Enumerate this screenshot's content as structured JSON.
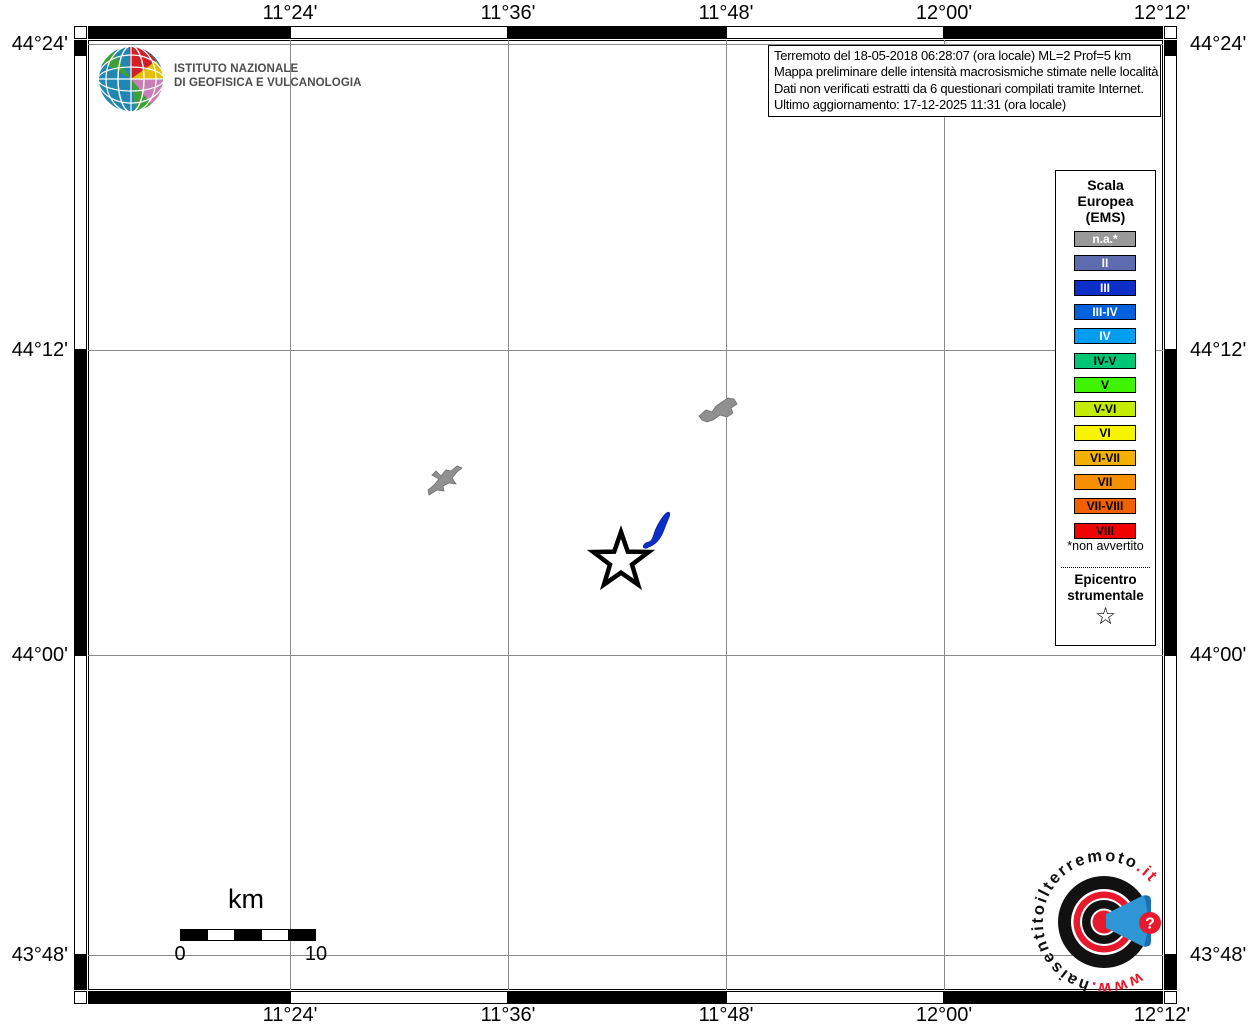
{
  "header": {
    "logo": {
      "line1": "ISTITUTO NAZIONALE",
      "line2": "DI GEOFISICA E VULCANOLOGIA"
    },
    "info_box": {
      "lines": [
        "Terremoto del 18-05-2018 06:28:07 (ora locale) ML=2 Prof=5 km",
        "Mappa preliminare delle intensità macrosismiche stimate nelle località",
        "Dati non verificati estratti da 6 questionari compilati tramite Internet.",
        "Ultimo aggiornamento: 17-12-2025 11:31 (ora locale)"
      ]
    }
  },
  "axes": {
    "top": [
      "11°24'",
      "11°36'",
      "11°48'",
      "12°00'",
      "12°12'"
    ],
    "bottom": [
      "11°24'",
      "11°36'",
      "11°48'",
      "12°00'",
      "12°12'"
    ],
    "left": [
      "44°24'",
      "44°12'",
      "44°00'",
      "43°48'"
    ],
    "right": [
      "44°24'",
      "44°12'",
      "44°00'",
      "43°48'"
    ]
  },
  "legend": {
    "title_lines": [
      "Scala",
      "Europea",
      "(EMS)"
    ],
    "items": [
      {
        "label": "n.a.*",
        "color": "#999999",
        "text_color": "#ffffff"
      },
      {
        "label": "II",
        "color": "#5c6cae",
        "text_color": "#ffffff"
      },
      {
        "label": "III",
        "color": "#0d2ec8",
        "text_color": "#ffffff"
      },
      {
        "label": "III-IV",
        "color": "#0060dd",
        "text_color": "#ffffff"
      },
      {
        "label": "IV",
        "color": "#009df0",
        "text_color": "#ffffff"
      },
      {
        "label": "IV-V",
        "color": "#00c775",
        "text_color": "#000000"
      },
      {
        "label": "V",
        "color": "#3ef400",
        "text_color": "#000000"
      },
      {
        "label": "V-VI",
        "color": "#c3ec00",
        "text_color": "#000000"
      },
      {
        "label": "VI",
        "color": "#f7f400",
        "text_color": "#000000"
      },
      {
        "label": "VI-VII",
        "color": "#f2b000",
        "text_color": "#000000"
      },
      {
        "label": "VII",
        "color": "#f79000",
        "text_color": "#000000"
      },
      {
        "label": "VII-VIII",
        "color": "#f06000",
        "text_color": "#000000"
      },
      {
        "label": "VIII",
        "color": "#f30000",
        "text_color": "#000000"
      }
    ],
    "footnote": "*non avvertito",
    "epicenter_label_lines": [
      "Epicentro",
      "strumentale"
    ],
    "epicenter_symbol": "☆"
  },
  "scalebar": {
    "unit": "km",
    "start": "0",
    "end": "10"
  },
  "map": {
    "epicenter": {
      "symbol": "star",
      "x": 621,
      "y": 561
    },
    "localities": [
      {
        "intensity": "n.a.",
        "color": "#909090",
        "x": 445,
        "y": 480
      },
      {
        "intensity": "n.a.",
        "color": "#909090",
        "x": 718,
        "y": 409
      },
      {
        "intensity": "III",
        "color": "#0d2ec8",
        "x": 658,
        "y": 530
      }
    ]
  },
  "watermark": {
    "full": "www.haisentitoilterremoto.it",
    "red_prefix": "www.",
    "black_mid": "haisentitoilterremoto",
    "red_suffix": ".it",
    "question_mark": "?",
    "red": "#e8192c",
    "blue": "#2f96d5"
  }
}
